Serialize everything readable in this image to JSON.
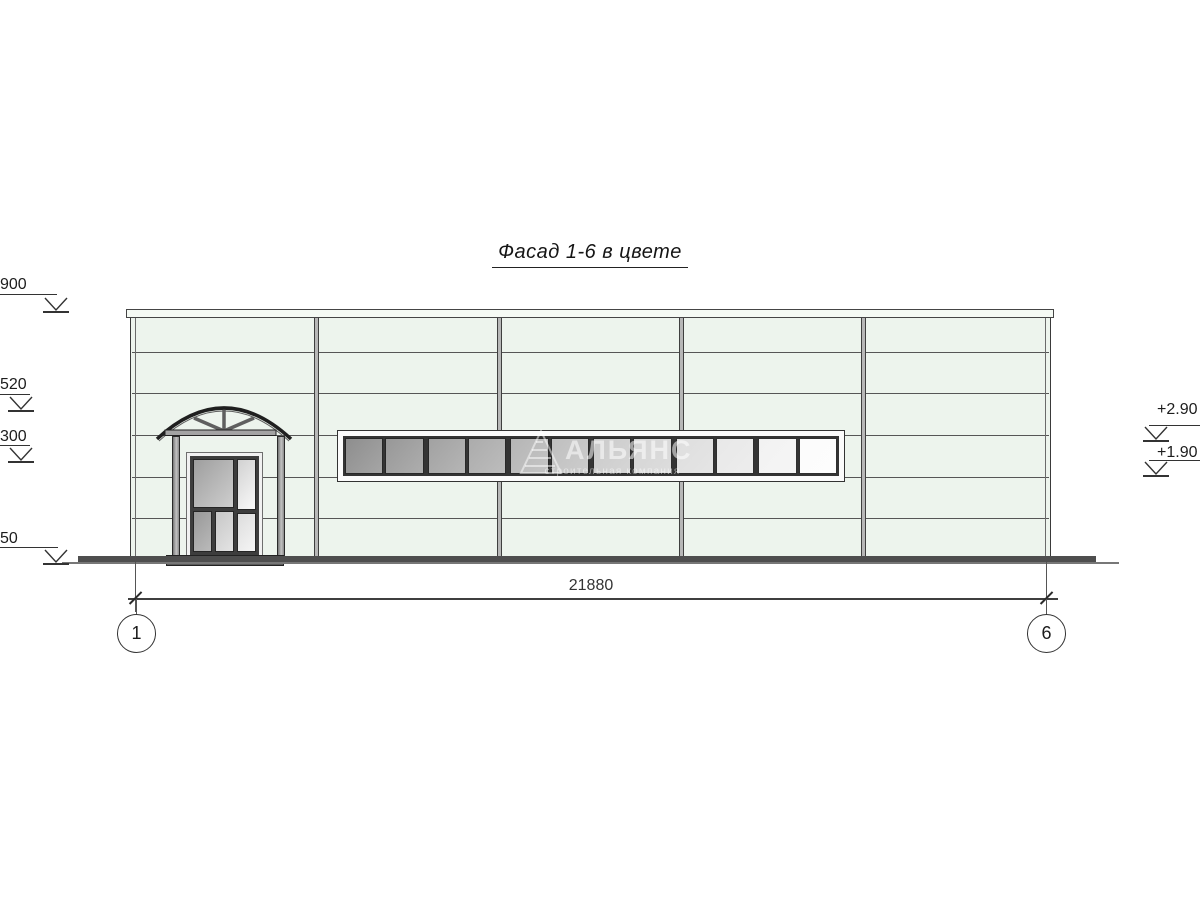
{
  "title": "Фасад 1-6 в цвете",
  "watermark": {
    "name": "АЛЬЯНС",
    "subtitle": "строительная компания",
    "logo": "triangle-ladder-logo"
  },
  "dimension": {
    "total": "21880"
  },
  "axes": {
    "left": "1",
    "right": "6"
  },
  "elevation_marks": {
    "left": [
      {
        "value": "900"
      },
      {
        "value": "520"
      },
      {
        "value": "300"
      },
      {
        "value": "50"
      }
    ],
    "right": [
      {
        "value": "+2.90"
      },
      {
        "value": "+1.90"
      }
    ]
  },
  "window": {
    "pane_count": 12,
    "group_size": 2,
    "pane_color_start": "#8d8d8d",
    "pane_color_end": "#fcfcfc"
  },
  "colors": {
    "wall": "#edf4ed",
    "parapet": "#f5faf4",
    "line": "#565656",
    "outline": "#3a3a3a",
    "mullion": "#b7b7b7",
    "frame_white": "#fbfbfb",
    "ground": "#4e4e4e",
    "metal": "#9c9c9c"
  }
}
